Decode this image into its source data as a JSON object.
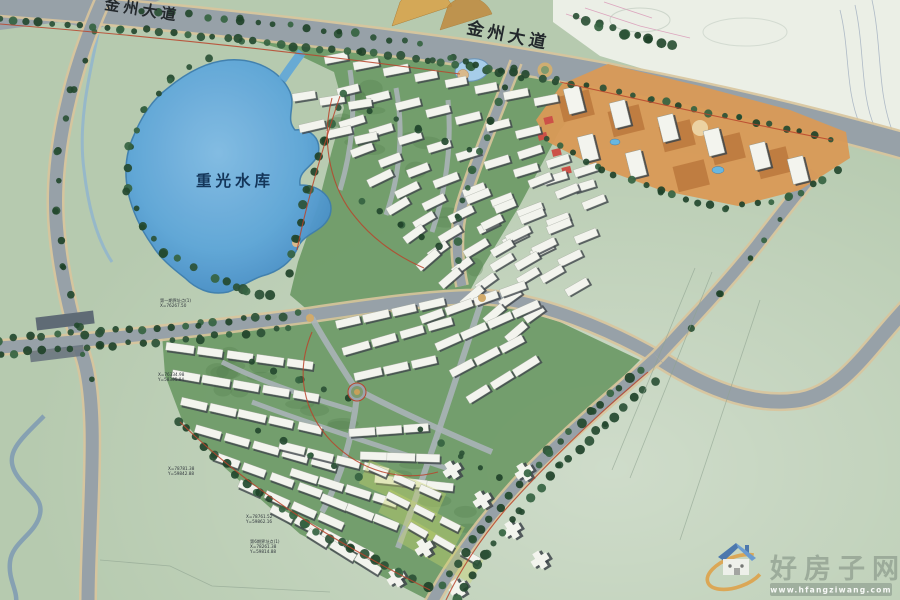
{
  "map": {
    "title": "residential district master plan",
    "labels": {
      "main_road": "金州大道",
      "main_road_west": "金州大道",
      "reservoir": "重光水库"
    },
    "survey_annotations": [
      {
        "x": 160,
        "y": 302,
        "lines": [
          "第一期界址点(1)",
          "X=76267.50"
        ]
      },
      {
        "x": 158,
        "y": 376,
        "lines": [
          "X=76334.98",
          "Y=58365.84"
        ]
      },
      {
        "x": 168,
        "y": 470,
        "lines": [
          "X=78781.38",
          "Y=59842.88"
        ]
      },
      {
        "x": 246,
        "y": 518,
        "lines": [
          "X=78761.52",
          "Y=59862.16"
        ]
      },
      {
        "x": 250,
        "y": 543,
        "lines": [
          "第6期界址点(1)",
          "X=78261.38",
          "Y=59814.88"
        ]
      }
    ],
    "colors": {
      "field_green": "#b6caaf",
      "site_green": "#6f9b68",
      "lake_blue": "#5fa6d8",
      "lake_deep": "#4f97cd",
      "road_gray": "#97a1a8",
      "road_edge_tan": "#d8c49c",
      "commercial_orange": "#d89a57",
      "podium_orange": "#bd7a3e",
      "tree_green": "#2b5136",
      "accent_red": "#b8442c",
      "building_white": "#f3f4ee",
      "building_shadow": "#3e454b"
    }
  },
  "watermark": {
    "site_name": "好房子网",
    "site_url": "www.hfangziwang.com",
    "logo_orange": "#e09a3a",
    "logo_blue": "#4a7fc1",
    "url_bar_green": "#96a596"
  }
}
